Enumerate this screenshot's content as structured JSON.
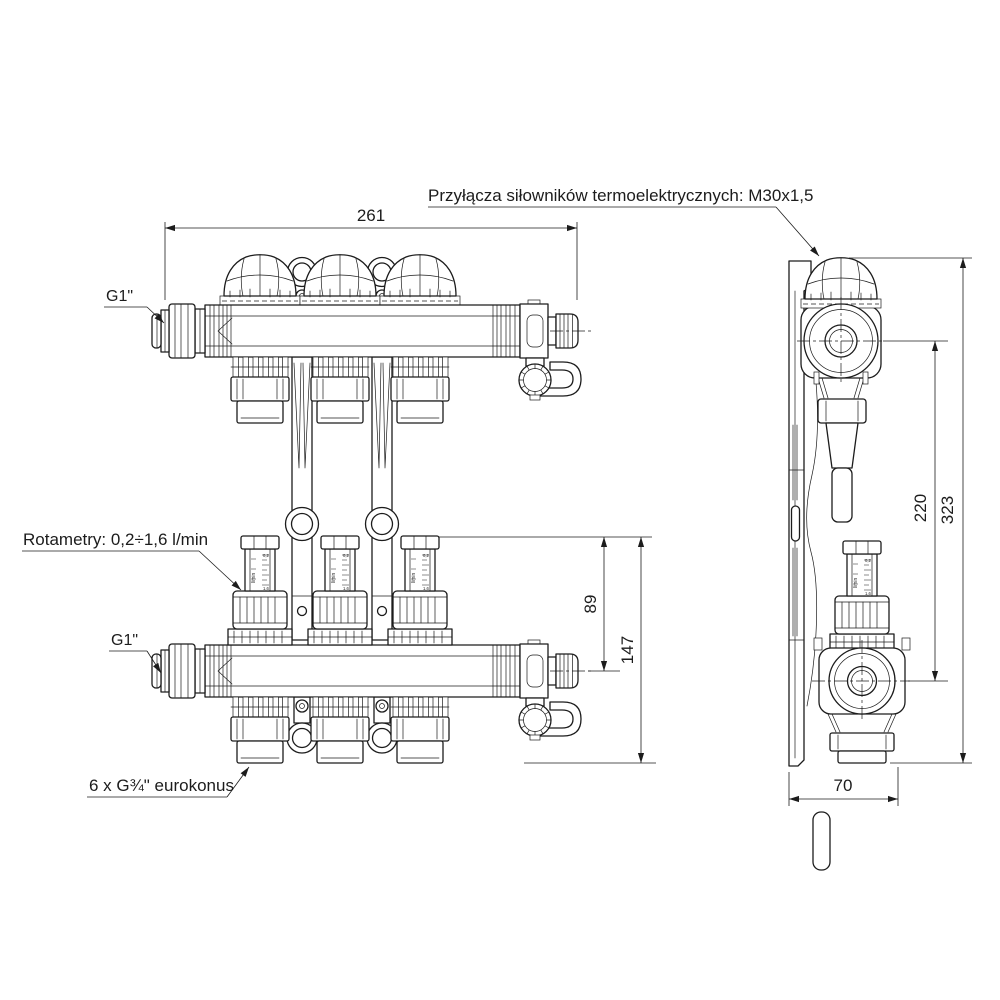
{
  "labels": {
    "actuator_ports": "Przyłącza siłowników termoelektrycznych: M30x1,5",
    "supply_port": "G1\"",
    "return_port": "G1\"",
    "flow_meters": "Rotametry: 0,2÷1,6 l/min",
    "loop_outlets": "6 x G¾\" eurokonus"
  },
  "dimensions": {
    "overall_width_mm": "261",
    "flowmeter_top_to_axis_mm": "89",
    "flowmeter_top_to_bottom_mm": "147",
    "bar_axis_span_mm": "220",
    "overall_height_mm": "323",
    "depth_mm": "70"
  },
  "flow_meter_scale": {
    "unit": "l/min",
    "min": "0,2",
    "max": "1,6",
    "ticks": [
      "0,2",
      "0,4",
      "0,6",
      "0,8",
      "1,0",
      "1,2",
      "1,4",
      "1,6"
    ]
  },
  "style": {
    "line_color": "#1c1c1c",
    "background": "#ffffff"
  }
}
